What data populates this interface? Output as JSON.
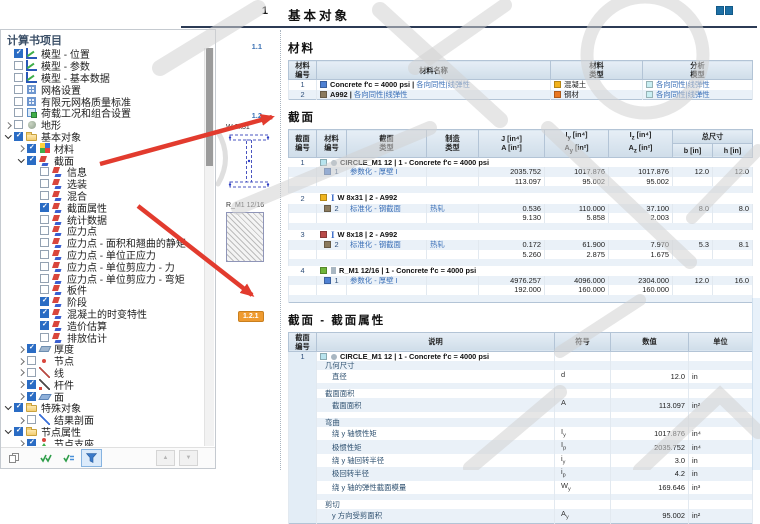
{
  "sidebar": {
    "title": "计算书项目",
    "items": [
      {
        "level": 1,
        "expand": "leaf",
        "cb": "checked",
        "icon": "chart",
        "label": "模型 - 位置"
      },
      {
        "level": 1,
        "expand": "leaf",
        "cb": "unchecked",
        "icon": "chart",
        "label": "模型 - 参数"
      },
      {
        "level": 1,
        "expand": "leaf",
        "cb": "unchecked",
        "icon": "chart",
        "label": "模型 - 基本数据"
      },
      {
        "level": 1,
        "expand": "leaf",
        "cb": "unchecked",
        "icon": "mesh",
        "label": "网格设置"
      },
      {
        "level": 1,
        "expand": "leaf",
        "cb": "unchecked",
        "icon": "mesh",
        "label": "有限元网格质量标准"
      },
      {
        "level": 1,
        "expand": "leaf",
        "cb": "unchecked",
        "icon": "load",
        "label": "荷载工况和组合设置"
      },
      {
        "level": 1,
        "expand": "closed",
        "cb": "unchecked",
        "icon": "terrain",
        "label": "地形"
      },
      {
        "level": 1,
        "expand": "open",
        "cb": "checked",
        "icon": "folder",
        "label": "基本对象"
      },
      {
        "level": 2,
        "expand": "closed",
        "cb": "checked",
        "icon": "material",
        "label": "材料"
      },
      {
        "level": 2,
        "expand": "open",
        "cb": "checked",
        "icon": "section",
        "label": "截面"
      },
      {
        "level": 3,
        "expand": "leaf",
        "cb": "unchecked",
        "icon": "section",
        "label": "信息"
      },
      {
        "level": 3,
        "expand": "leaf",
        "cb": "unchecked",
        "icon": "section",
        "label": "选装"
      },
      {
        "level": 3,
        "expand": "leaf",
        "cb": "unchecked",
        "icon": "section",
        "label": "混合"
      },
      {
        "level": 3,
        "expand": "leaf",
        "cb": "checked",
        "icon": "section",
        "label": "截面属性"
      },
      {
        "level": 3,
        "expand": "leaf",
        "cb": "unchecked",
        "icon": "section",
        "label": "统计数据"
      },
      {
        "level": 3,
        "expand": "leaf",
        "cb": "unchecked",
        "icon": "section",
        "label": "应力点"
      },
      {
        "level": 3,
        "expand": "leaf",
        "cb": "unchecked",
        "icon": "section",
        "label": "应力点 - 面积和翘曲的静矩"
      },
      {
        "level": 3,
        "expand": "leaf",
        "cb": "unchecked",
        "icon": "section",
        "label": "应力点 - 单位正应力"
      },
      {
        "level": 3,
        "expand": "leaf",
        "cb": "unchecked",
        "icon": "section",
        "label": "应力点 - 单位剪应力 - 力"
      },
      {
        "level": 3,
        "expand": "leaf",
        "cb": "unchecked",
        "icon": "section",
        "label": "应力点 - 单位剪应力 - 弯矩"
      },
      {
        "level": 3,
        "expand": "leaf",
        "cb": "unchecked",
        "icon": "section",
        "label": "板件"
      },
      {
        "level": 3,
        "expand": "leaf",
        "cb": "checked",
        "icon": "section",
        "label": "阶段"
      },
      {
        "level": 3,
        "expand": "leaf",
        "cb": "checked",
        "icon": "section",
        "label": "混凝土的时变特性"
      },
      {
        "level": 3,
        "expand": "leaf",
        "cb": "checked",
        "icon": "section",
        "label": "造价估算"
      },
      {
        "level": 3,
        "expand": "leaf",
        "cb": "unchecked",
        "icon": "section",
        "label": "排放估计"
      },
      {
        "level": 2,
        "expand": "closed",
        "cb": "checked",
        "icon": "thickness",
        "label": "厚度"
      },
      {
        "level": 2,
        "expand": "closed",
        "cb": "unchecked",
        "icon": "node",
        "label": "节点"
      },
      {
        "level": 2,
        "expand": "closed",
        "cb": "unchecked",
        "icon": "line",
        "label": "线"
      },
      {
        "level": 2,
        "expand": "closed",
        "cb": "checked",
        "icon": "member",
        "label": "杆件"
      },
      {
        "level": 2,
        "expand": "closed",
        "cb": "checked",
        "icon": "surface",
        "label": "面"
      },
      {
        "level": 1,
        "expand": "open",
        "cb": "checked",
        "icon": "folder",
        "label": "特殊对象"
      },
      {
        "level": 2,
        "expand": "closed",
        "cb": "unchecked",
        "icon": "rsection",
        "label": "结果剖面"
      },
      {
        "level": 1,
        "expand": "open",
        "cb": "checked",
        "icon": "folder",
        "label": "节点属性"
      },
      {
        "level": 2,
        "expand": "closed",
        "cb": "checked",
        "icon": "support",
        "label": "节点支座"
      }
    ],
    "toolbar": {
      "buttons": [
        "copy",
        "select-all",
        "invert-selection",
        "filter"
      ],
      "nav": [
        "scroll-up",
        "scroll-down"
      ]
    }
  },
  "report": {
    "chapter": {
      "number": "1",
      "title": "基本对象"
    },
    "materials": {
      "number": "1.1",
      "title": "材料",
      "h": {
        "no1": "材料",
        "no2": "编号",
        "name": "材料名称",
        "type1": "材料",
        "type2": "类型",
        "model1": "分析",
        "model2": "模型"
      },
      "rows": [
        {
          "no": "1",
          "swatch": "#4f81d3",
          "name": "Concrete f'c = 4000 psi |",
          "model_inline": "各向同性|线弹性",
          "type_swatch": "#f2b21c",
          "type": "混凝土",
          "model_swatch": "#c9eef2",
          "model": "各向同性|线弹性"
        },
        {
          "no": "2",
          "swatch": "#8a7a5e",
          "name": "A992 |",
          "model_inline": "各向同性|线弹性",
          "type_swatch": "#e87722",
          "type": "钢材",
          "model_swatch": "#c9eef2",
          "model": "各向同性|线弹性"
        }
      ]
    },
    "sections_table": {
      "number": "1.2",
      "title": "截面",
      "h": {
        "no1": "截面",
        "no2": "编号",
        "mat1": "材料",
        "mat2": "编号",
        "type1": "截面",
        "type2": "类型",
        "mfg1": "制造",
        "mfg2": "类型",
        "j1": "J [in⁴]",
        "j2": "A [in²]",
        "iy1a": "I",
        "iy1b": "y",
        "iy1c": " [in⁴]",
        "iy2a": "A",
        "iy2b": "y",
        "iy2c": " [in²]",
        "iz1a": "I",
        "iz1b": "z",
        "iz1c": " [in⁴]",
        "iz2a": "A",
        "iz2b": "z",
        "iz2c": " [in²]",
        "dims": "总尺寸",
        "b": "b [in]",
        "hh": "h [in]"
      },
      "thumbs": {
        "w_label": "W 8x31",
        "r_label": "R_M1 12/16"
      },
      "rows": [
        {
          "no": "1",
          "swatch": "#b8e4ee",
          "glyph": "circle",
          "title": "CIRCLE_M1 12 | 1 - Concrete f'c = 4000 psi",
          "mat_swatch": "#4f81d3",
          "mat_no": "1",
          "type": "参数化 - 厚壁 I",
          "mfg": "",
          "j": "2035.752",
          "a": "113.097",
          "iy": "1017.876",
          "ay": "95.002",
          "iz": "1017.876",
          "az": "95.002",
          "b": "12.0",
          "h": "12.0"
        },
        {
          "no": "2",
          "swatch": "#f0b51f",
          "glyph": "ibeam",
          "title": "W 8x31 | 2 - A992",
          "mat_swatch": "#8a7a5e",
          "mat_no": "2",
          "type": "标准化 - 钢截面",
          "mfg": "热轧",
          "j": "0.536",
          "a": "9.130",
          "iy": "110.000",
          "ay": "5.858",
          "iz": "37.100",
          "az": "2.003",
          "b": "8.0",
          "h": "8.0"
        },
        {
          "no": "3",
          "swatch": "#b94a48",
          "glyph": "ibeam",
          "title": "W 8x18 | 2 - A992",
          "mat_swatch": "#8a7a5e",
          "mat_no": "2",
          "type": "标准化 - 钢截面",
          "mfg": "热轧",
          "j": "0.172",
          "a": "5.260",
          "iy": "61.900",
          "ay": "2.875",
          "iz": "7.970",
          "az": "1.675",
          "b": "5.3",
          "h": "8.1"
        },
        {
          "no": "4",
          "swatch": "#6fb53a",
          "glyph": "rect",
          "title": "R_M1 12/16 | 1 - Concrete f'c = 4000 psi",
          "mat_swatch": "#4f81d3",
          "mat_no": "1",
          "type": "参数化 - 厚壁 I",
          "mfg": "",
          "j": "4976.257",
          "a": "192.000",
          "iy": "4096.000",
          "ay": "160.000",
          "iz": "2304.000",
          "az": "160.000",
          "b": "12.0",
          "h": "16.0"
        }
      ]
    },
    "properties": {
      "number": "1.2.1",
      "title": "截面 - 截面属性",
      "h": {
        "no1": "截面",
        "no2": "编号",
        "desc": "说明",
        "sym": "符号",
        "val": "数值",
        "unit": "单位"
      },
      "section_row": {
        "no": "1",
        "swatch": "#b8e4ee",
        "glyph": "circle",
        "title": "CIRCLE_M1 12 | 1 - Concrete f'c = 4000 psi"
      },
      "rows": [
        {
          "type": "group",
          "label": "几何尺寸",
          "sym": "",
          "sub": "",
          "val": "",
          "unit": ""
        },
        {
          "type": "item",
          "label": "直径",
          "sym": "d",
          "sub": "",
          "val": "12.0",
          "unit": "in"
        },
        {
          "type": "spacer",
          "label": "",
          "sym": "",
          "sub": "",
          "val": "",
          "unit": ""
        },
        {
          "type": "group",
          "label": "截面面积",
          "sym": "",
          "sub": "",
          "val": "",
          "unit": ""
        },
        {
          "type": "item",
          "label": "截面面积",
          "sym": "A",
          "sub": "",
          "val": "113.097",
          "unit": "in²"
        },
        {
          "type": "spacer",
          "label": "",
          "sym": "",
          "sub": "",
          "val": "",
          "unit": ""
        },
        {
          "type": "group",
          "label": "弯曲",
          "sym": "",
          "sub": "",
          "val": "",
          "unit": ""
        },
        {
          "type": "item",
          "label": "绕 y 轴惯性矩",
          "sym": "I",
          "sub": "y",
          "val": "1017.876",
          "unit": "in⁴"
        },
        {
          "type": "item",
          "label": "极惯性矩",
          "sym": "I",
          "sub": "p",
          "val": "2035.752",
          "unit": "in⁴"
        },
        {
          "type": "item",
          "label": "绕 y 轴回转半径",
          "sym": "i",
          "sub": "y",
          "val": "3.0",
          "unit": "in"
        },
        {
          "type": "item",
          "label": "极回转半径",
          "sym": "i",
          "sub": "p",
          "val": "4.2",
          "unit": "in"
        },
        {
          "type": "item",
          "label": "绕 y 轴的弹性截面模量",
          "sym": "W",
          "sub": "y",
          "val": "169.646",
          "unit": "in³"
        },
        {
          "type": "spacer",
          "label": "",
          "sym": "",
          "sub": "",
          "val": "",
          "unit": ""
        },
        {
          "type": "group",
          "label": "剪切",
          "sym": "",
          "sub": "",
          "val": "",
          "unit": ""
        },
        {
          "type": "item",
          "label": "y 方向受剪面积",
          "sym": "A",
          "sub": "y",
          "val": "95.002",
          "unit": "in²"
        }
      ]
    }
  }
}
